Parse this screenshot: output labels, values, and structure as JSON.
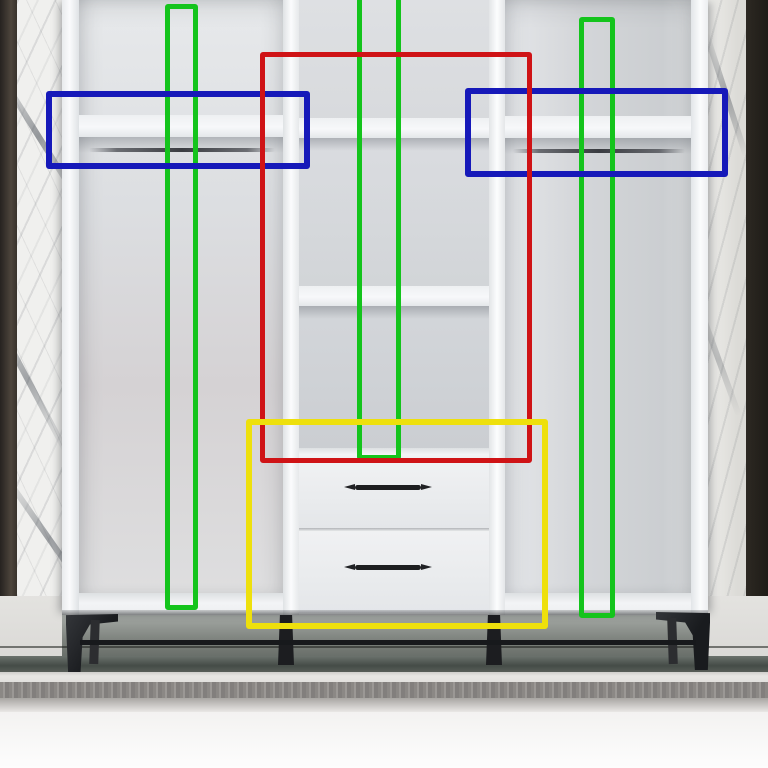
{
  "image_type": "photograph with object-detection overlay",
  "scene": {
    "subject": "open white wardrobe interior with shelves, two hanging rails, three middle cubbies and two drawers with black bar handles",
    "background": "white marble wall panels with dark trim strips on both sides, tiled floor, gray carpet runner in front",
    "furniture_parts": [
      "left-compartment-shelf",
      "left-hanging-rail",
      "middle-cubby-top",
      "middle-cubby-center",
      "middle-cubby-bottom",
      "top-drawer",
      "bottom-drawer",
      "drawer-handle",
      "drawer-handle",
      "right-compartment-shelf",
      "right-hanging-rail",
      "black-metal-legs",
      "metal-stretcher-bar"
    ]
  },
  "annotation_colors": {
    "green": "#14c41c",
    "blue": "#1619b9",
    "red": "#cf1316",
    "yellow": "#eee00c"
  },
  "annotations": [
    {
      "name": "bbox-green-left",
      "color_label": "green",
      "color": "#14c41c",
      "x": 165,
      "y": 4,
      "w": 33,
      "h": 606,
      "stroke": 5
    },
    {
      "name": "bbox-green-middle",
      "color_label": "green",
      "color": "#14c41c",
      "x": 357,
      "y": -8,
      "w": 44,
      "h": 468,
      "stroke": 5
    },
    {
      "name": "bbox-green-right",
      "color_label": "green",
      "color": "#14c41c",
      "x": 579,
      "y": 17,
      "w": 36,
      "h": 601,
      "stroke": 5
    },
    {
      "name": "bbox-blue-left",
      "color_label": "blue",
      "color": "#1619b9",
      "x": 46,
      "y": 91,
      "w": 264,
      "h": 78,
      "stroke": 6
    },
    {
      "name": "bbox-blue-right",
      "color_label": "blue",
      "color": "#1619b9",
      "x": 465,
      "y": 88,
      "w": 263,
      "h": 89,
      "stroke": 6
    },
    {
      "name": "bbox-red",
      "color_label": "red",
      "color": "#cf1316",
      "x": 260,
      "y": 52,
      "w": 272,
      "h": 411,
      "stroke": 5
    },
    {
      "name": "bbox-yellow",
      "color_label": "yellow",
      "color": "#eee00c",
      "x": 246,
      "y": 419,
      "w": 302,
      "h": 210,
      "stroke": 6
    }
  ]
}
